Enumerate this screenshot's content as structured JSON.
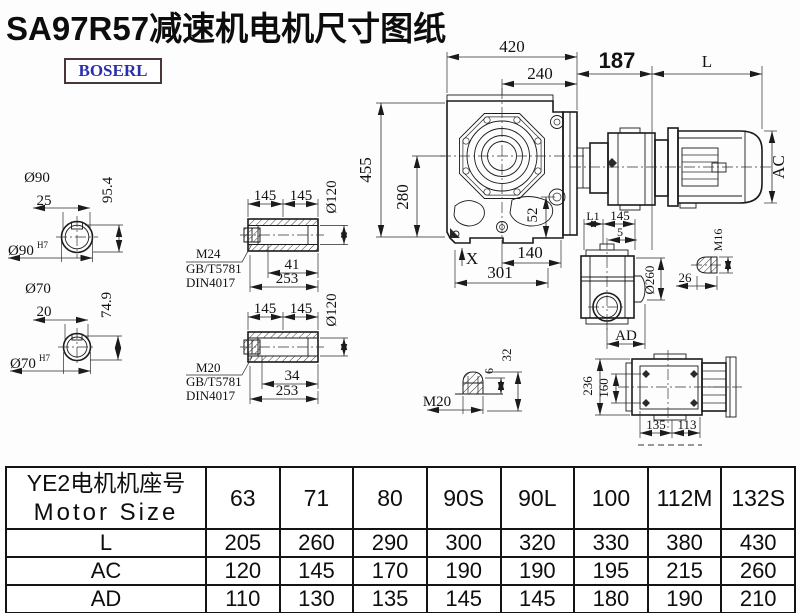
{
  "title": "SA97R57减速机电机尺寸图纸",
  "logo": {
    "text": "BOSERL"
  },
  "drawing": {
    "front": {
      "d420": "420",
      "d240": "240",
      "d455": "455",
      "d280": "280",
      "d52": "52",
      "dX": "X",
      "d140": "140",
      "d301": "301"
    },
    "motor": {
      "d187": "187",
      "dL": "L",
      "dAC": "AC"
    },
    "shaft90": {
      "dia": "Ø90",
      "d25": "25",
      "d954": "95.4",
      "diah7": "Ø90",
      "sup": "H7"
    },
    "shaft70": {
      "dia": "Ø70",
      "d20": "20",
      "d749": "74.9",
      "diah7": "Ø70",
      "sup": "H7"
    },
    "hollow1": {
      "d145a": "145",
      "d145b": "145",
      "dia120": "Ø120",
      "m": "M24",
      "std1": "GB/T5781",
      "std2": "DIN4017",
      "d41": "41",
      "d253": "253"
    },
    "hollow2": {
      "d145a": "145",
      "d145b": "145",
      "dia120": "Ø120",
      "m": "M20",
      "std1": "GB/T5781",
      "std2": "DIN4017",
      "d34": "34",
      "d253": "253"
    },
    "side": {
      "dL1": "L1",
      "d145": "145",
      "d5": "5",
      "dia260": "Ø260",
      "dAD": "AD"
    },
    "bolt16": {
      "m": "M16",
      "d26": "26"
    },
    "bolt20": {
      "m": "M20",
      "d6": "6",
      "d32": "32"
    },
    "rear": {
      "d236": "236",
      "d160": "160",
      "d135": "135",
      "d113": "113"
    }
  },
  "table": {
    "header_cn": "YE2电机机座号",
    "header_en": "Motor Size",
    "sizes": [
      "63",
      "71",
      "80",
      "90S",
      "90L",
      "100",
      "112M",
      "132S"
    ],
    "rows": [
      {
        "label": "L",
        "values": [
          "205",
          "260",
          "290",
          "300",
          "320",
          "330",
          "380",
          "430"
        ]
      },
      {
        "label": "AC",
        "values": [
          "120",
          "145",
          "170",
          "190",
          "190",
          "195",
          "215",
          "260"
        ]
      },
      {
        "label": "AD",
        "values": [
          "110",
          "130",
          "135",
          "145",
          "145",
          "180",
          "190",
          "210"
        ]
      }
    ]
  }
}
